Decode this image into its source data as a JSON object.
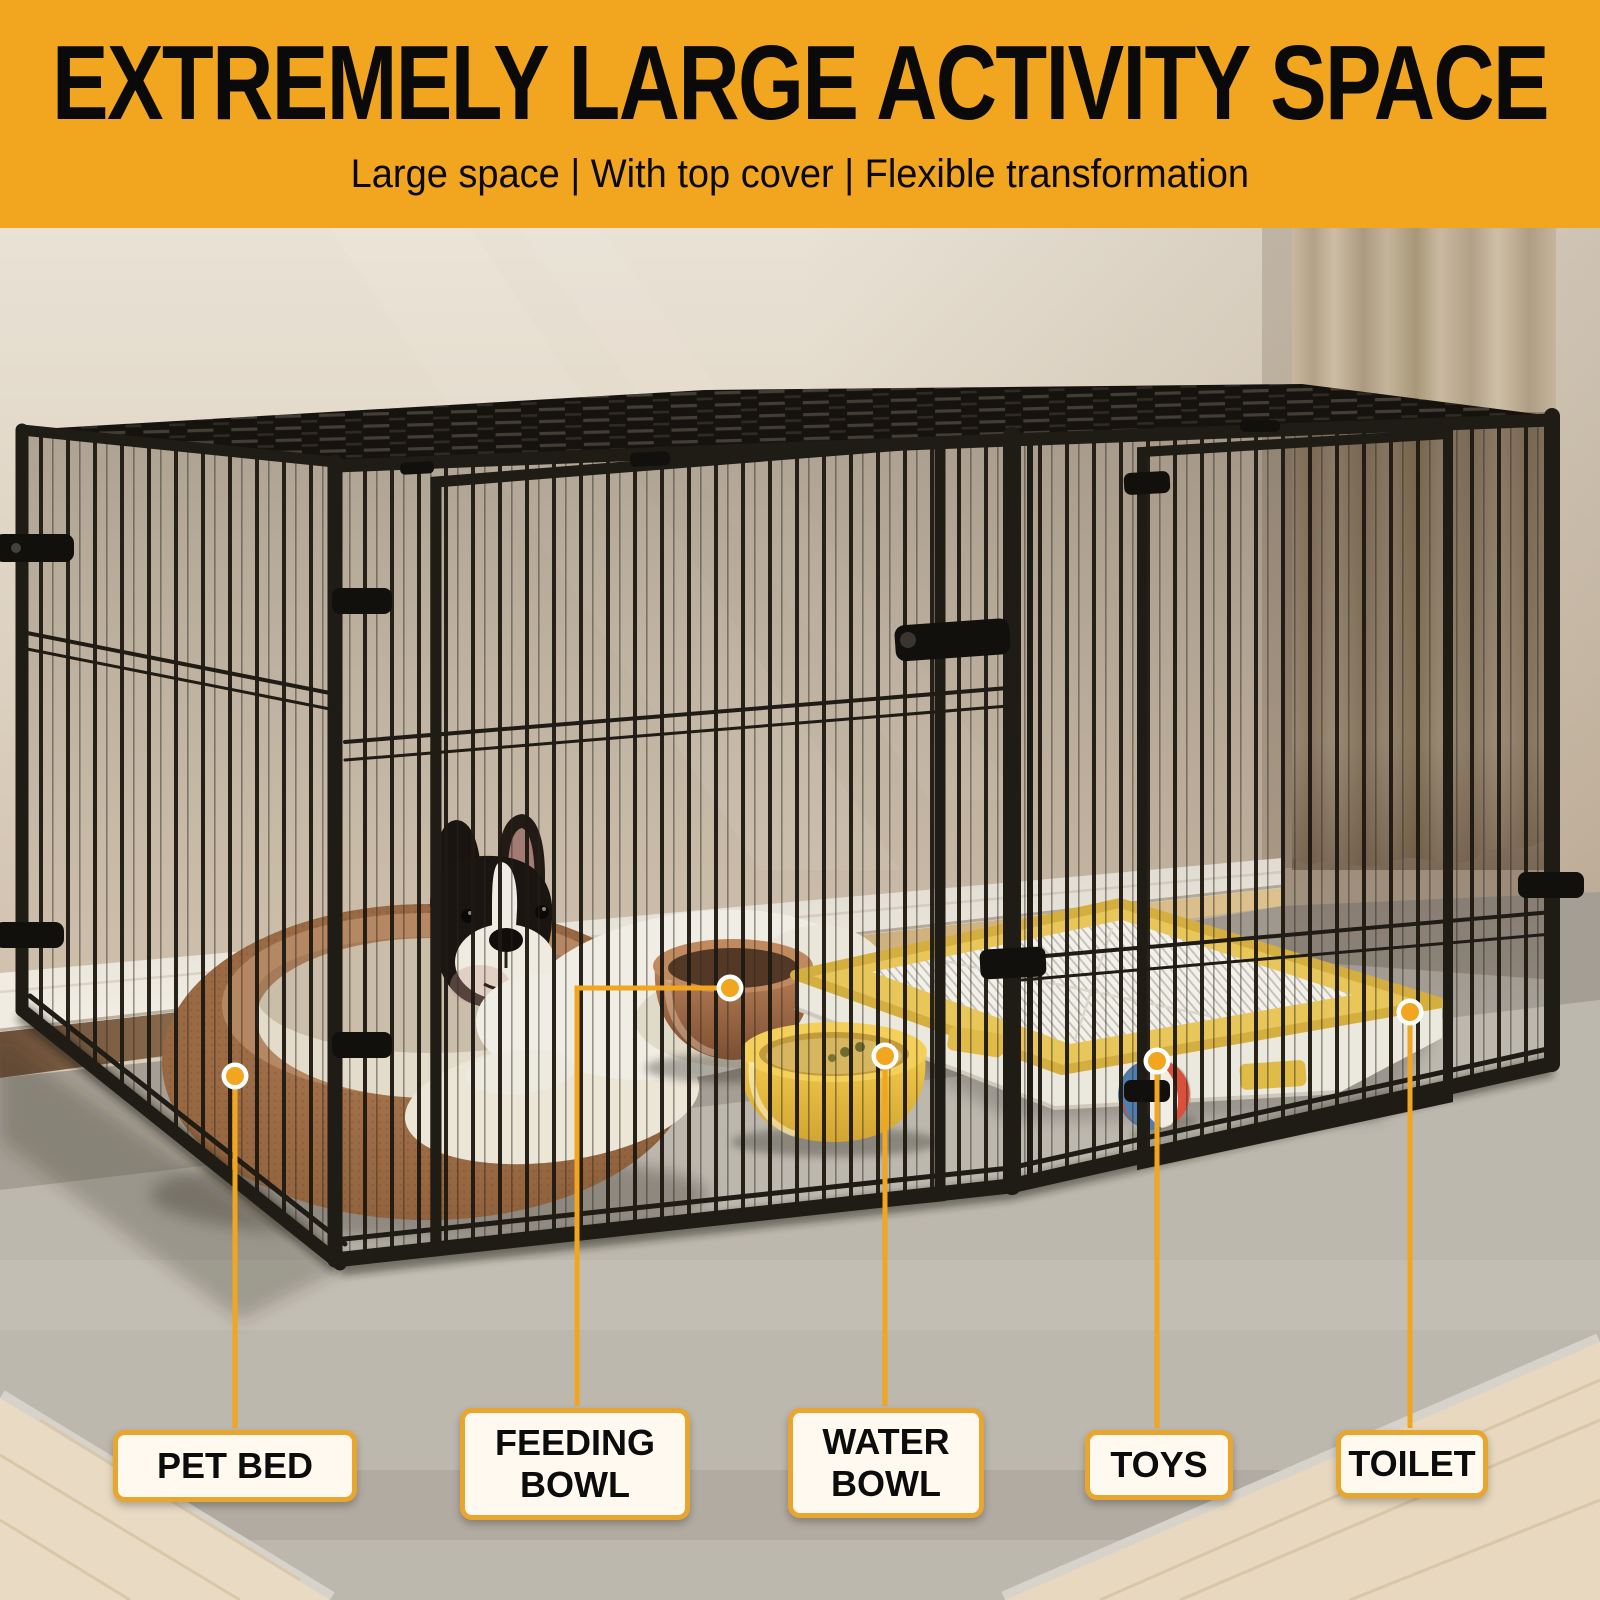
{
  "header": {
    "title": "EXTREMELY LARGE ACTIVITY SPACE",
    "subtitle": "Large space | With top cover | Flexible transformation"
  },
  "callouts": [
    {
      "label": "PET BED"
    },
    {
      "label": "FEEDING BOWL"
    },
    {
      "label": "WATER BOWL"
    },
    {
      "label": "TOYS"
    },
    {
      "label": "TOILET"
    }
  ],
  "colors": {
    "accent": "#F2A51F",
    "header_text": "#0A0A0A",
    "callout_border": "#E8A62E",
    "callout_bg": "#FFF9F0",
    "callout_text": "#0C0C0C"
  }
}
